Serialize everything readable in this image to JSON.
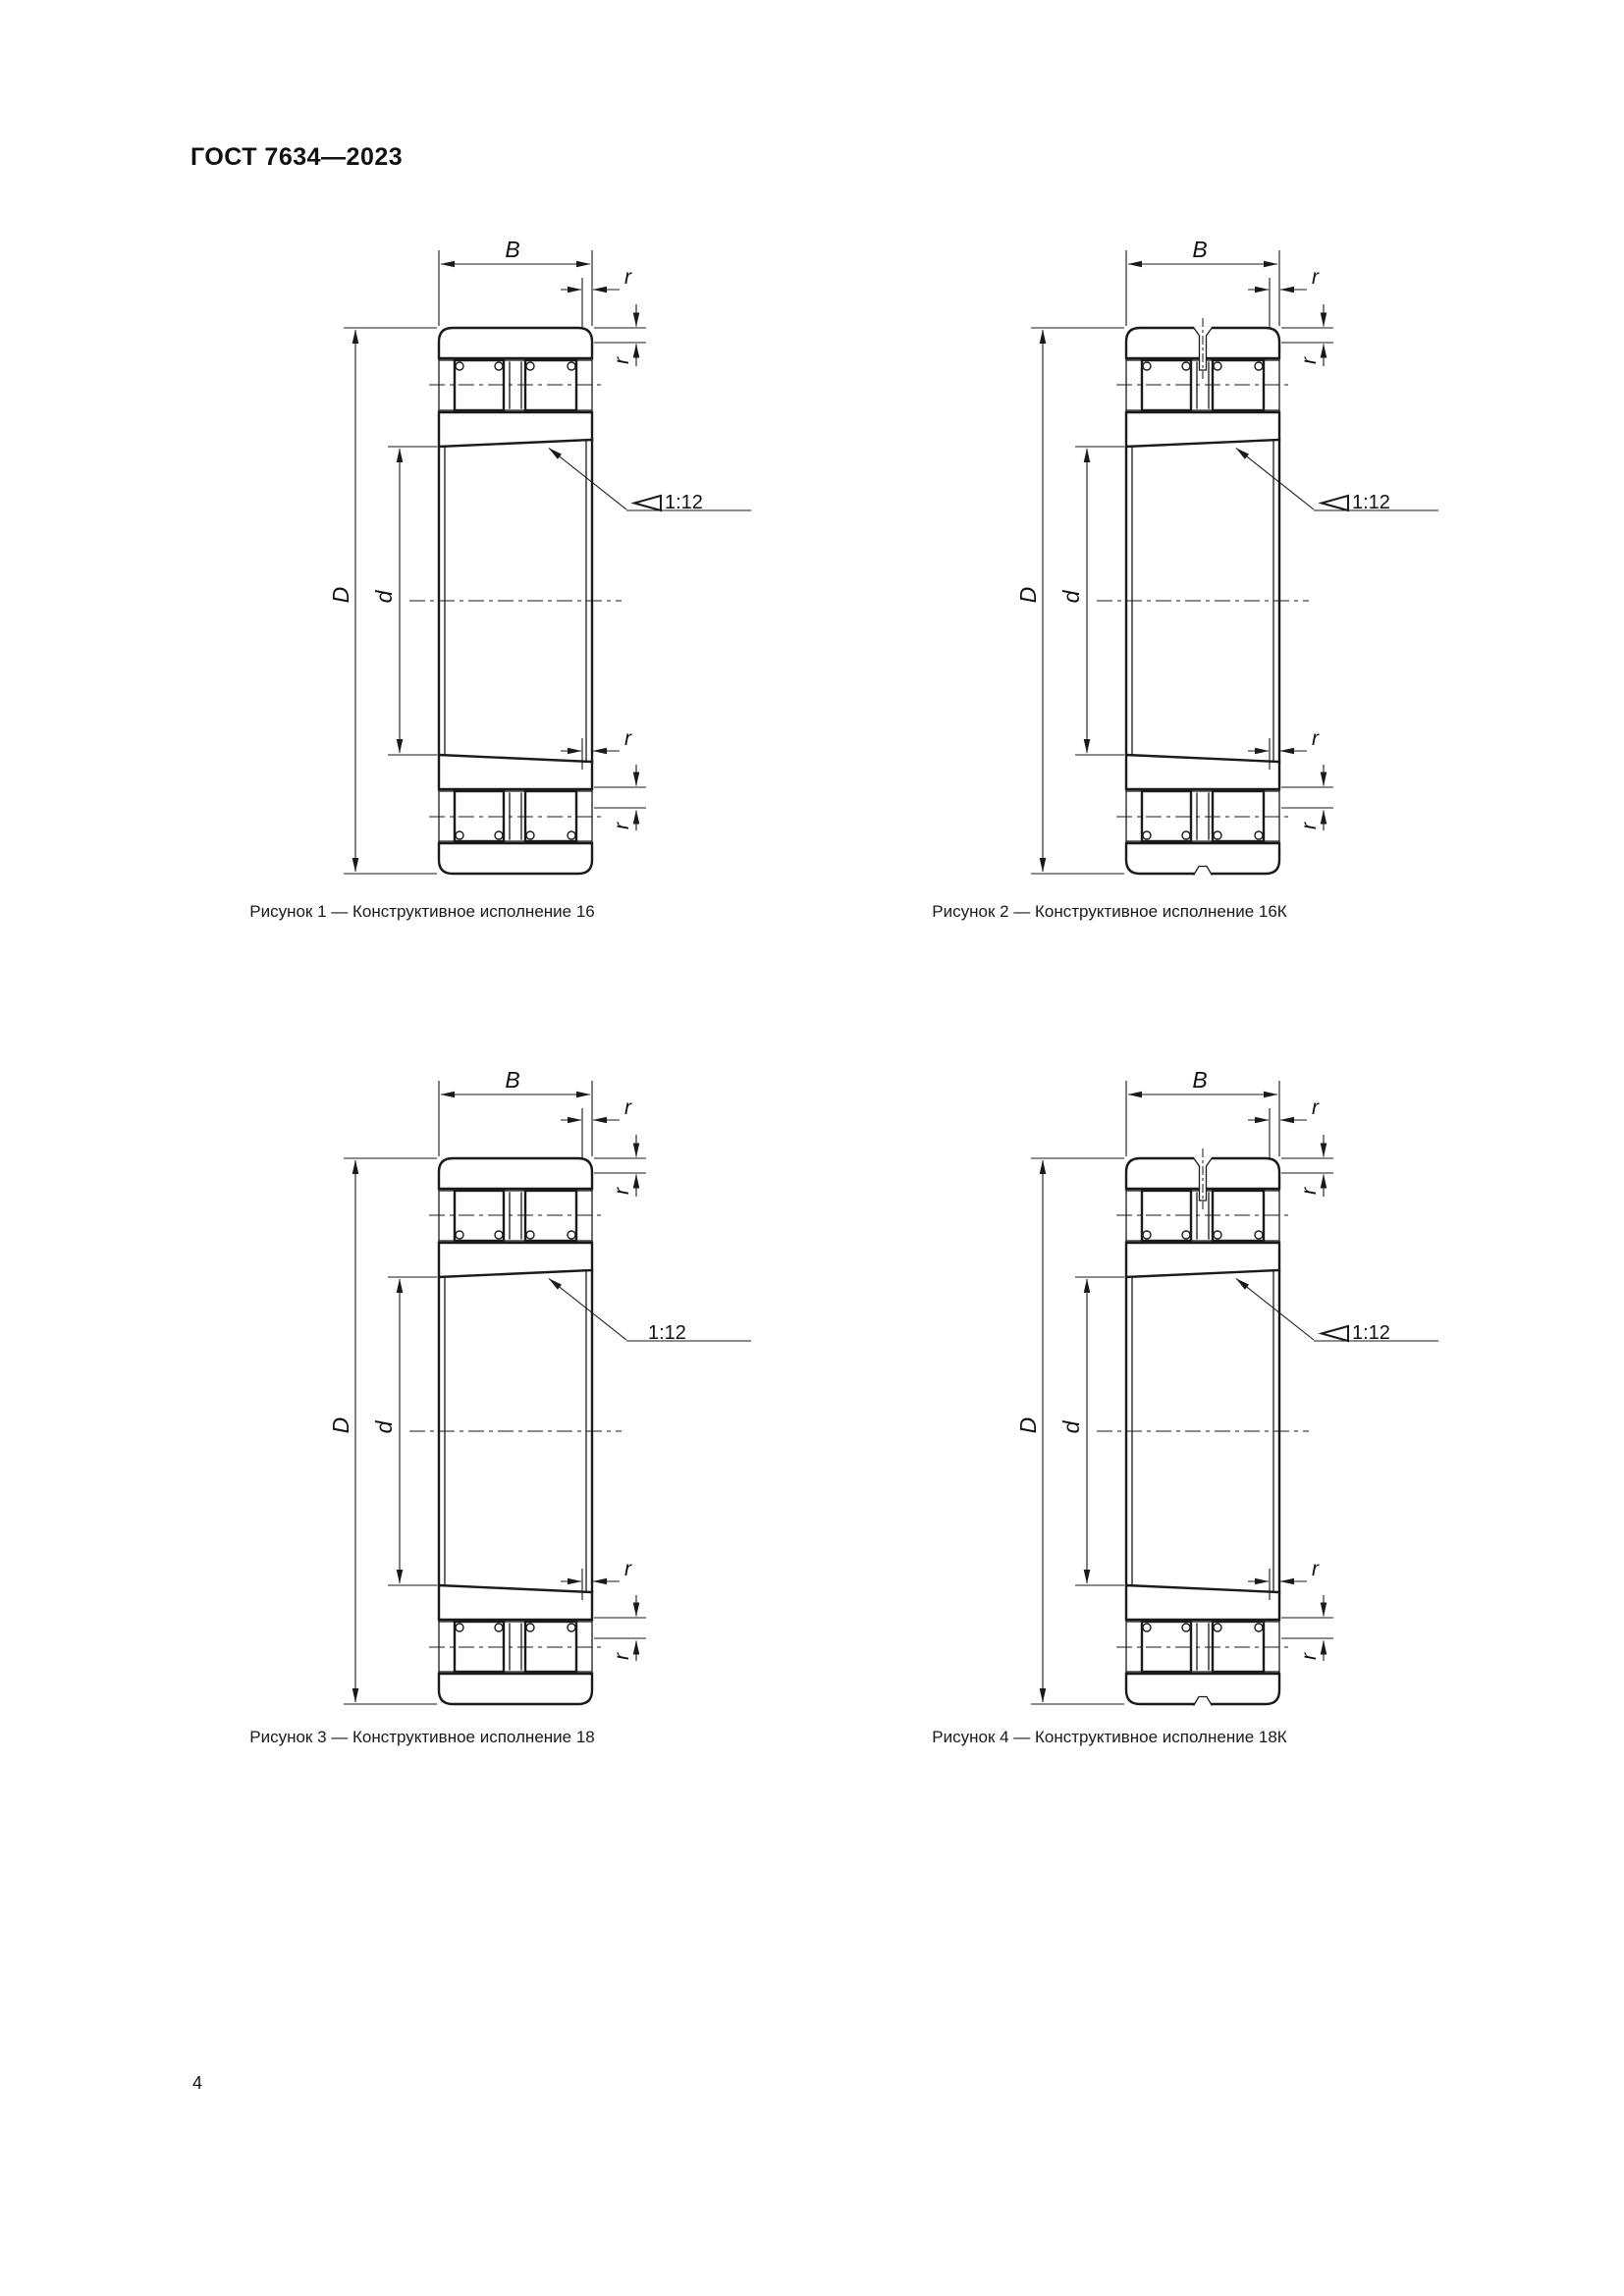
{
  "header": {
    "title": "ГОСТ 7634—2023"
  },
  "page_number": "4",
  "dims": {
    "width_label": "B",
    "outer_diameter_label": "D",
    "bore_diameter_label": "d",
    "chamfer_radius_label": "r",
    "taper_label": "1:12"
  },
  "figures": [
    {
      "caption": "Рисунок 1 — Конструктивное исполнение 16",
      "variant": "16",
      "taper_symbol": true,
      "slot": false
    },
    {
      "caption": "Рисунок 2 — Конструктивное исполнение 16К",
      "variant": "16К",
      "taper_symbol": true,
      "slot": true
    },
    {
      "caption": "Рисунок 3 — Конструктивное исполнение 18",
      "variant": "18",
      "taper_symbol": false,
      "slot": false
    },
    {
      "caption": "Рисунок 4 — Конструктивное исполнение 18К",
      "variant": "18К",
      "taper_symbol": true,
      "slot": true
    }
  ]
}
